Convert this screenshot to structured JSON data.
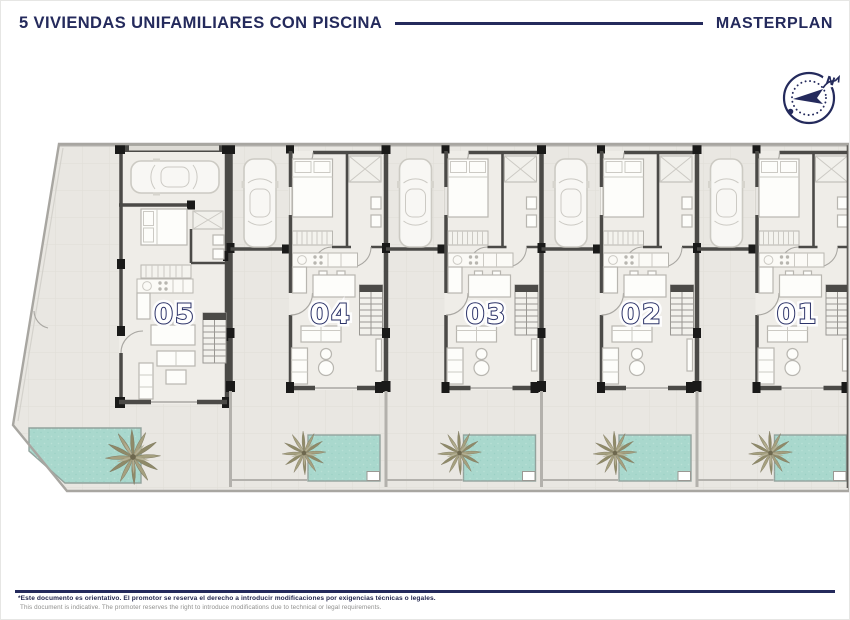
{
  "header": {
    "title": "5 VIVIENDAS UNIFAMILIARES CON PISCINA",
    "plan_label": "MASTERPLAN"
  },
  "compass": {
    "north_label": "N"
  },
  "plan": {
    "units": [
      {
        "number": "05"
      },
      {
        "number": "04"
      },
      {
        "number": "03"
      },
      {
        "number": "02"
      },
      {
        "number": "01"
      }
    ]
  },
  "footer": {
    "disclaimer_es": "*Este documento es orientativo. El promotor se reserva el derecho a introducir modificaciones por exigencias técnicas o legales.",
    "disclaimer_en": "This document is indicative. The promoter reserves the right to introduce modifications due to technical or legal requirements."
  },
  "colors": {
    "accent_navy": "#242a5c",
    "pool": "#a9d8cd",
    "wall": "#4b4a47",
    "ground": "#e9e7e2"
  }
}
